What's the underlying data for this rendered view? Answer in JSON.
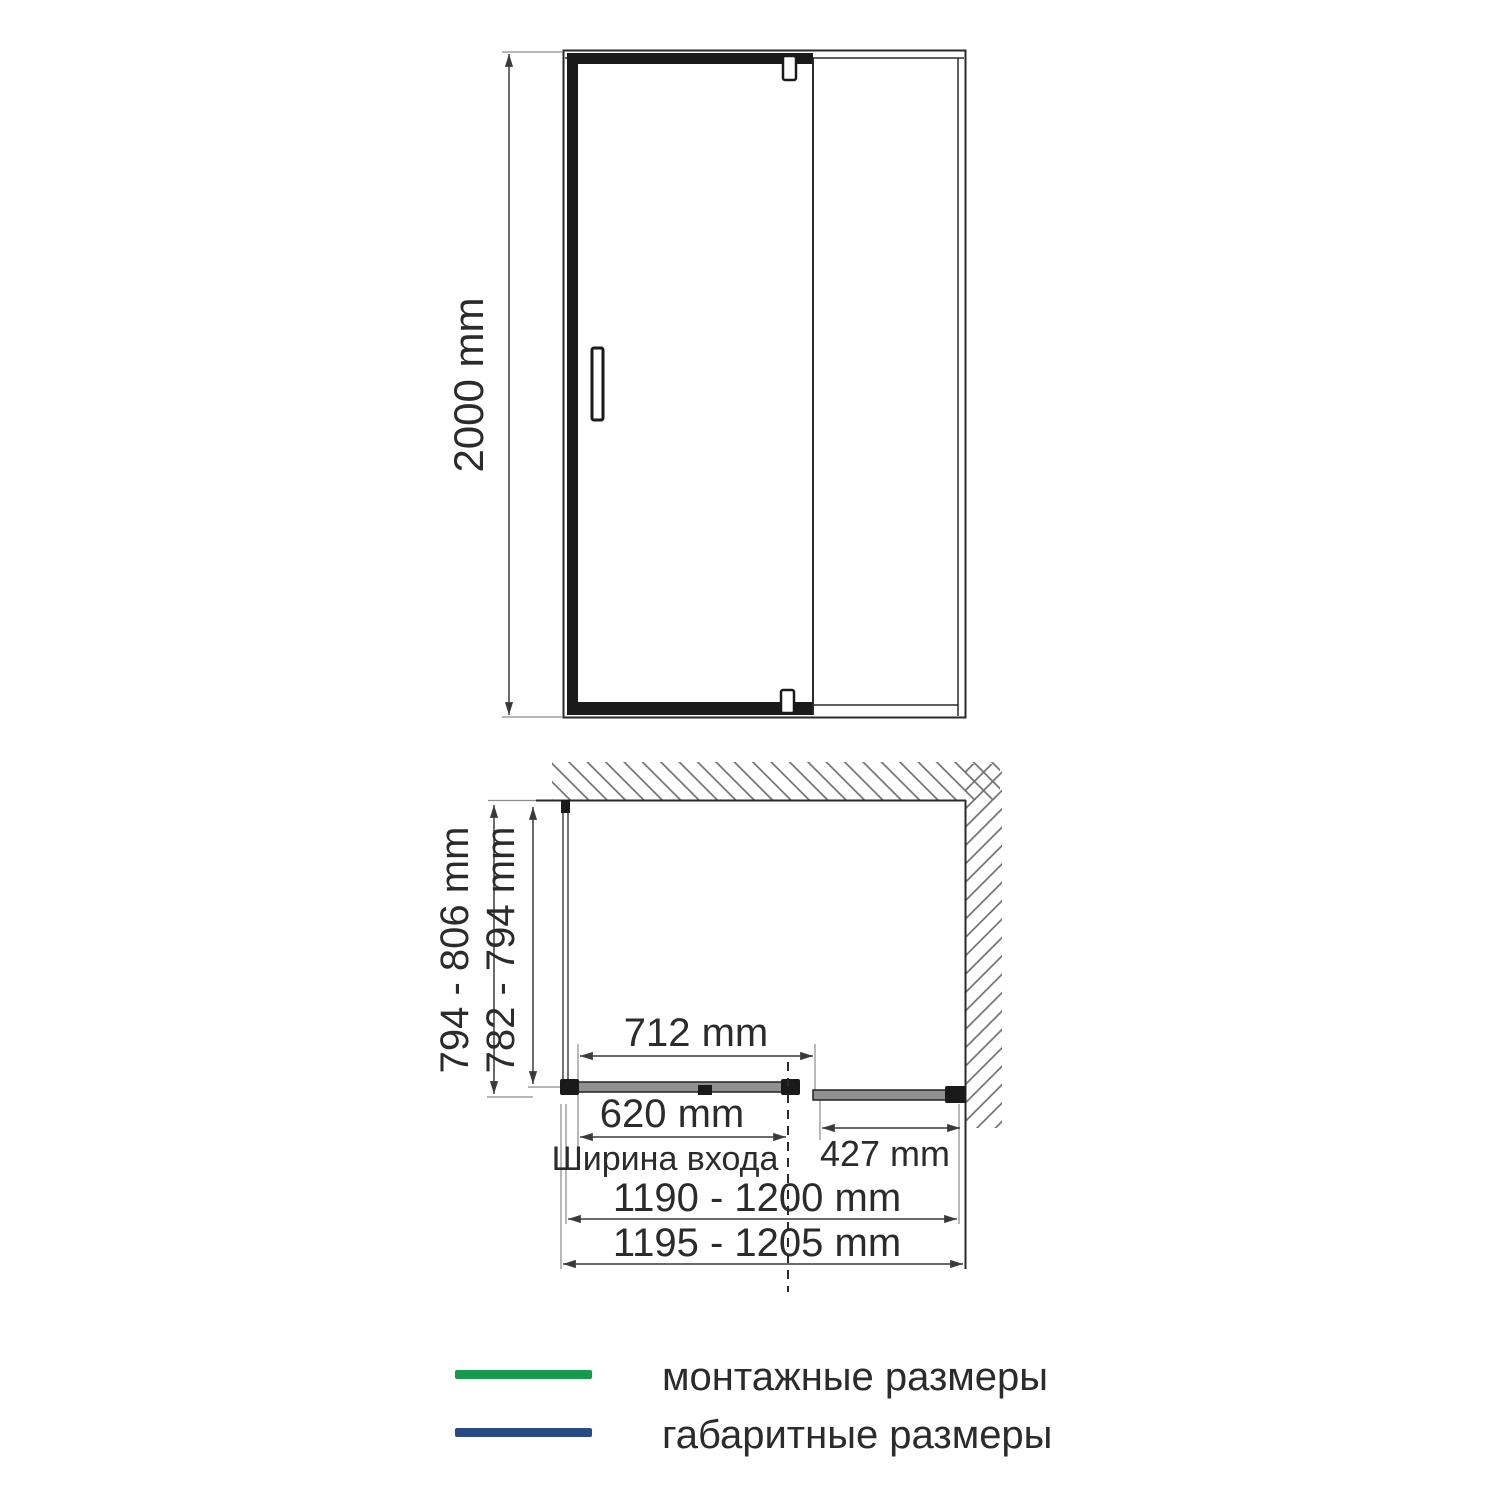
{
  "colors": {
    "green": "#169b4e",
    "navy": "#2a4a85",
    "ink": "#2b2b2b"
  },
  "front_view": {
    "height_dim": "2000 mm"
  },
  "plan_view": {
    "depth_overall_dim": "794 - 806 mm",
    "depth_mounting_dim": "782 - 794 mm",
    "door_panel_width_dim": "712 mm",
    "entrance_width_dim": "620 mm",
    "entrance_width_label": "Ширина входа",
    "fixed_panel_width_dim": "427 mm",
    "width_mounting_dim": "1190 - 1200 mm",
    "width_overall_dim": "1195 - 1205 mm"
  },
  "legend": {
    "mounting_label": "монтажные размеры",
    "overall_label": "габаритные размеры"
  }
}
